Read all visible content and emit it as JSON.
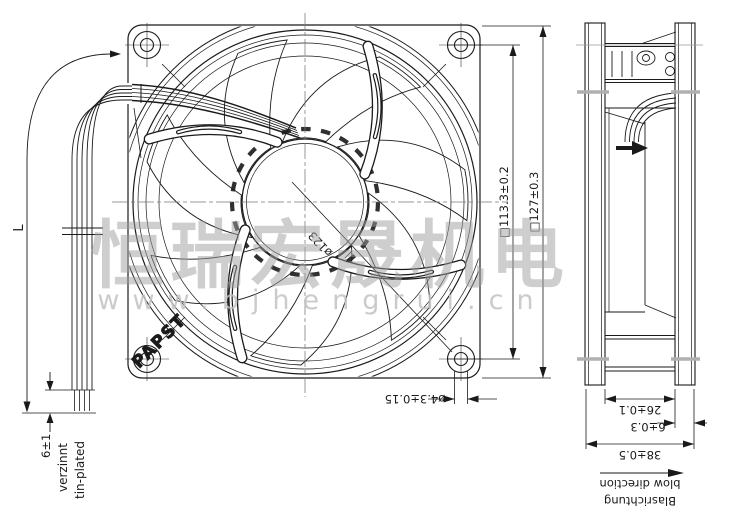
{
  "document": {
    "type": "fan dimensional drawing",
    "views": [
      "front view",
      "side view"
    ]
  },
  "watermark": {
    "company_name": "恒瑞宏晟机电",
    "website": "www.bjhengrui.cn"
  },
  "front_view": {
    "brand_logo": "PAPST",
    "labels": {
      "lead_length": "L",
      "strip_length": "6±1",
      "strip_finish_de": "verzinnt",
      "strip_finish_en": "tin-plated",
      "impeller_diameter": "ø123",
      "mounting_hole_spacing": "□113.3±0.2",
      "frame_size": "□127±0.3",
      "mounting_hole_diameter": "ø4.3±0.15"
    }
  },
  "side_view": {
    "labels": {
      "inner_depth": "26±0.1",
      "flange_depth": "6±0.3",
      "overall_depth": "38±0.5",
      "airflow_label_de": "Blasrichtung",
      "airflow_label_en": "blow direction"
    }
  },
  "colors": {
    "line": "#1a1a1a",
    "centerline": "#777777",
    "section_mark": "#b0b0b0",
    "watermark_text": "#9f9f9f",
    "watermark_url": "#c3c3c3",
    "background": "#ffffff"
  }
}
